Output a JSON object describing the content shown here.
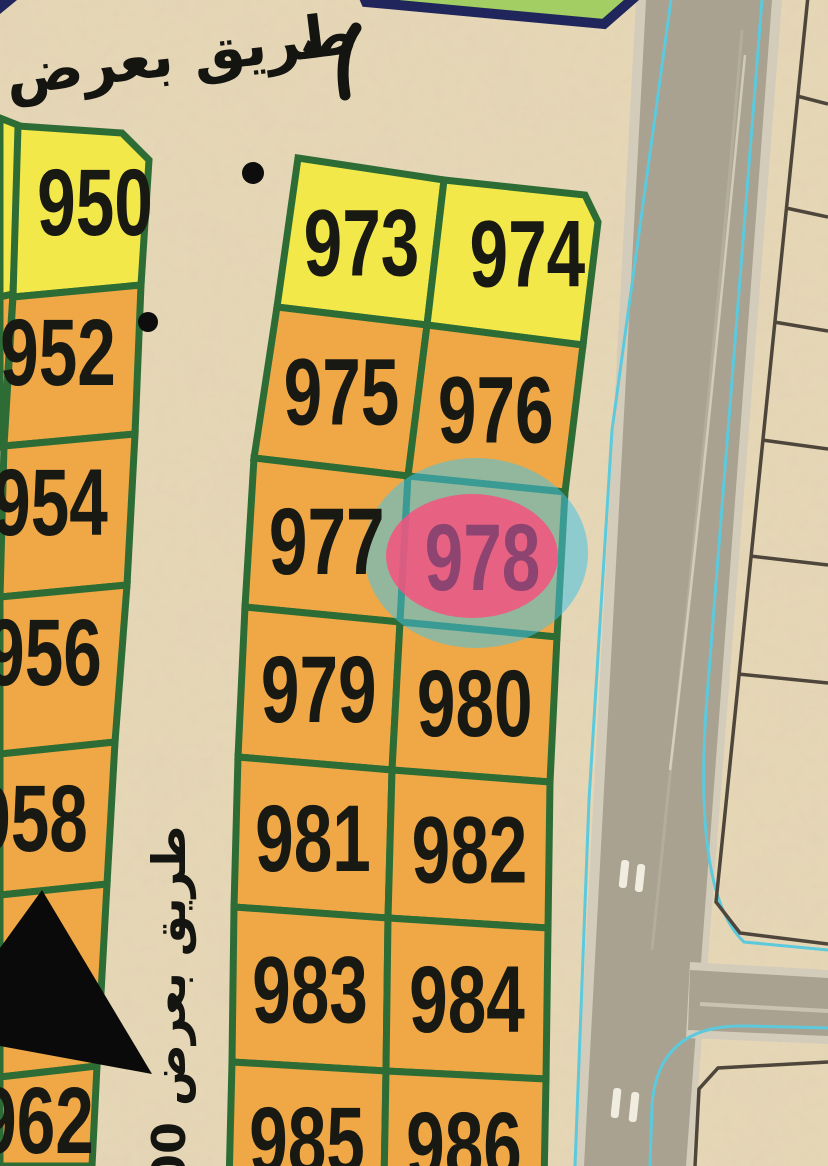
{
  "map": {
    "top_road_label": "طريق بعرض",
    "side_road_label": "طريق بعرض 00",
    "highlighted_plot": "978",
    "left_column_plots": [
      {
        "label": "950"
      },
      {
        "label": "952"
      },
      {
        "label": "954"
      },
      {
        "label": "956"
      },
      {
        "label": "958"
      },
      {
        "label": ""
      },
      {
        "label": "962"
      }
    ],
    "middle_block_rows": [
      {
        "left": "973",
        "right": "974"
      },
      {
        "left": "975",
        "right": "976"
      },
      {
        "left": "977",
        "right": "978"
      },
      {
        "left": "979",
        "right": "980"
      },
      {
        "left": "981",
        "right": "982"
      },
      {
        "left": "983",
        "right": "984"
      },
      {
        "left": "985",
        "right": "986"
      }
    ],
    "yellow_plots": [
      "950",
      "973",
      "974"
    ],
    "colors": {
      "sand": "#e5d6b6",
      "plot_yellow": "#f3e84a",
      "plot_orange": "#efa845",
      "plot_border_green": "#2d6c35",
      "road_asphalt": "#a9a291",
      "road_shoulder": "#d3ccba",
      "waterline_cyan": "#5cc9dc",
      "parcel_outline": "#4e463b",
      "boundary_navy": "#20255c",
      "green_area": "#a3ce63",
      "highlight_blue": "#45c2e4",
      "highlight_pink": "#f4527e",
      "plot_label": "#191914",
      "highlight_label": "#8e4470"
    }
  }
}
